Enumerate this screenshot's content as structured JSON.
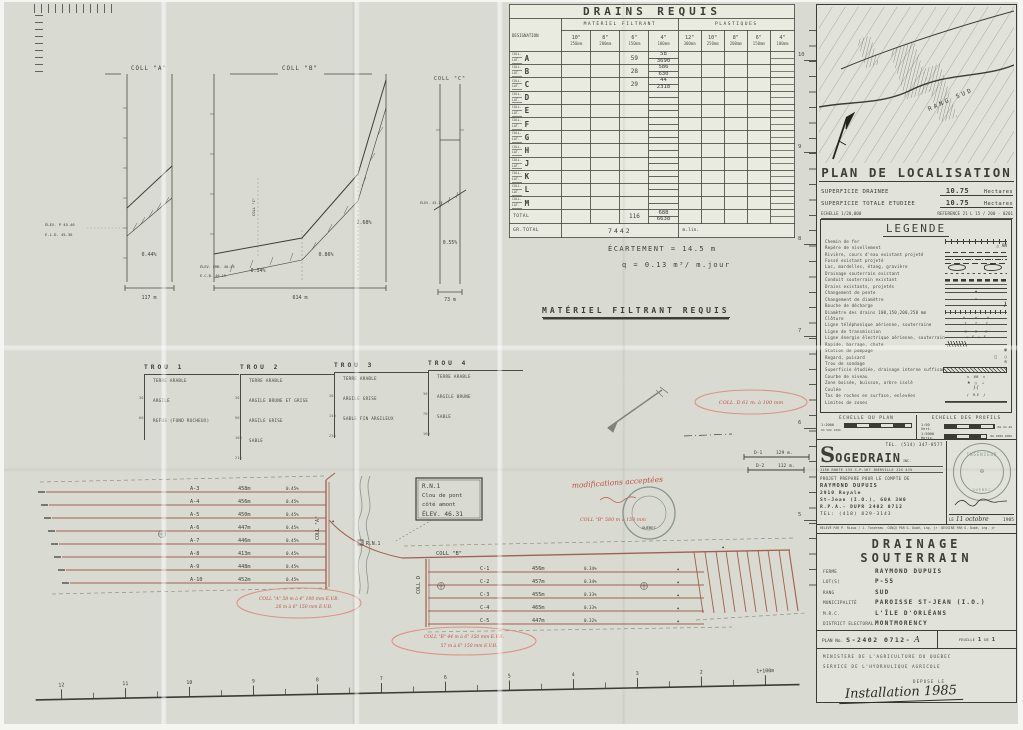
{
  "drains_table": {
    "title": "DRAINS REQUIS",
    "designation": "DESIGNATION",
    "group_filtrant": "MATÉRIEL FILTRANT",
    "group_plastiques": "PLASTIQUES",
    "coll_label": "COLL.",
    "lat_label": "LAT.",
    "cols_filtrant": [
      {
        "size": "10\"",
        "mm": "250mm"
      },
      {
        "size": "8\"",
        "mm": "200mm"
      },
      {
        "size": "6\"",
        "mm": "150mm"
      },
      {
        "size": "4\"",
        "mm": "100mm"
      }
    ],
    "cols_plastiques": [
      {
        "size": "12\"",
        "mm": "300mm"
      },
      {
        "size": "10\"",
        "mm": "250mm"
      },
      {
        "size": "8\"",
        "mm": "200mm"
      },
      {
        "size": "6\"",
        "mm": "150mm"
      },
      {
        "size": "4\"",
        "mm": "100mm"
      }
    ],
    "rows": [
      {
        "letter": "A",
        "f150": "59",
        "f100a": "58",
        "f100b": "3690"
      },
      {
        "letter": "B",
        "f150": "28",
        "f100a": "586",
        "f100b": "630"
      },
      {
        "letter": "C",
        "f150": "29",
        "f100a": "44",
        "f100b": "2318"
      },
      {
        "letter": "D",
        "f150": "",
        "f100a": "",
        "f100b": ""
      },
      {
        "letter": "E",
        "f150": "",
        "f100a": "",
        "f100b": ""
      },
      {
        "letter": "F",
        "f150": "",
        "f100a": "",
        "f100b": ""
      },
      {
        "letter": "G",
        "f150": "",
        "f100a": "",
        "f100b": ""
      },
      {
        "letter": "H",
        "f150": "",
        "f100a": "",
        "f100b": ""
      },
      {
        "letter": "J",
        "f150": "",
        "f100a": "",
        "f100b": ""
      },
      {
        "letter": "K",
        "f150": "",
        "f100a": "",
        "f100b": ""
      },
      {
        "letter": "L",
        "f150": "",
        "f100a": "",
        "f100b": ""
      },
      {
        "letter": "M",
        "f150": "",
        "f100a": "",
        "f100b": ""
      }
    ],
    "total_label": "TOTAL",
    "total_f150": "116",
    "total_f100a": "688",
    "total_f100b": "6638",
    "grand_total_label": "GR.TOTAL",
    "grand_total": "7442",
    "grand_total_unit": "m.lin."
  },
  "spacing": {
    "ecartement": "ÉCARTEMENT  =  14.5 m",
    "debit": "q =  0.13 m³/ m.jour",
    "heading": "MATÉRIEL  FILTRANT  REQUIS"
  },
  "profiles": {
    "coll_a": {
      "title": "COLL \"A\"",
      "slope": "0.44%",
      "length": "117 m",
      "note1": "ÉLEV. P  45.46",
      "note2": "E.L.D.  45.36"
    },
    "coll_b": {
      "title": "COLL \"B\"",
      "junction": "COLL \"C\"",
      "slope1": "0.34%",
      "slope2": "0.86%",
      "slope3": "2.68%",
      "length": "614 m",
      "note1": "ÉLEV. EMB.  40.45",
      "note2": "E.C.B.  40.19"
    },
    "coll_c": {
      "title": "COLL \"C\"",
      "slope": "0.55%",
      "length": "73 m",
      "note": "ÉLEV.  43.17"
    }
  },
  "trous": [
    {
      "title": "TROU 1",
      "layers": [
        {
          "d": "30",
          "n": "TERRE ARABLE"
        },
        {
          "d": "60",
          "n": "ARGILE"
        },
        {
          "d": "",
          "n": "REFUS (FOND ROCHEUX)"
        }
      ]
    },
    {
      "title": "TROU 2",
      "layers": [
        {
          "d": "30",
          "n": "TERRE ARABLE"
        },
        {
          "d": "90",
          "n": "ARGILE BRUNE ET GRISE"
        },
        {
          "d": "160",
          "n": "ARGILE GRISE"
        },
        {
          "d": "210",
          "n": "SABLE"
        }
      ]
    },
    {
      "title": "TROU 3",
      "layers": [
        {
          "d": "30",
          "n": "TERRE ARABLE"
        },
        {
          "d": "140",
          "n": "ARGILE GRISE"
        },
        {
          "d": "230",
          "n": "SABLE FIN ARGILEUX"
        }
      ]
    },
    {
      "title": "TROU 4",
      "layers": [
        {
          "d": "30",
          "n": "TERRE ARABLE"
        },
        {
          "d": "70",
          "n": "ARGILE BRUNE"
        },
        {
          "d": "160",
          "n": "SABLE"
        }
      ]
    }
  ],
  "plan": {
    "laterals_a": [
      {
        "id": "A-3",
        "len": "458m"
      },
      {
        "id": "A-4",
        "len": "456m"
      },
      {
        "id": "A-5",
        "len": "450m"
      },
      {
        "id": "A-6",
        "len": "447m"
      },
      {
        "id": "A-7",
        "len": "446m"
      },
      {
        "id": "A-8",
        "len": "413m"
      },
      {
        "id": "A-9",
        "len": "448m"
      },
      {
        "id": "A-10",
        "len": "452m"
      }
    ],
    "slope_a": "0.45%",
    "coll_a": "COLL \"A\"",
    "coll_b": "COLL \"B\"",
    "coll_d": "COLL D",
    "laterals_c": [
      {
        "id": "C-1",
        "len": "456m",
        "s": "0.34%"
      },
      {
        "id": "C-2",
        "len": "457m",
        "s": "0.34%"
      },
      {
        "id": "C-3",
        "len": "455m",
        "s": "0.33%"
      },
      {
        "id": "C-4",
        "len": "465m",
        "s": "0.33%"
      },
      {
        "id": "C-5",
        "len": "447m",
        "s": "0.32%"
      }
    ],
    "rn1": {
      "l1": "R.N.1",
      "l2": "Clou de pont",
      "l3": "côté amont",
      "l4": "ÉLEV. 46.31",
      "marker": "R.N.1"
    },
    "d1": {
      "id": "D-1",
      "len": "129 m."
    },
    "d2": {
      "id": "D-2",
      "len": "112 m."
    },
    "red_notes": {
      "modifications": "modifications acceptées",
      "coll_d": "COLL. D   61 m. à 100 mm",
      "coll_b_inline": "COLL \"B\"  580 m à 150 mm",
      "coll_a_1": "COLL \"A\"   58 m à 4\" 100 mm  E.V.B.",
      "coll_a_2": "26 m à 6\" 150 mm  E.V.B.",
      "coll_b_1": "COLL \"B\"   44 m à 6\" 150 mm  E.V.B.",
      "coll_b_2": "57 m à 6\" 150 mm  E.V.B."
    },
    "stamp_text": "QUÉBEC"
  },
  "localisation": {
    "title": "PLAN DE LOCALISATION",
    "rows": [
      {
        "label": "SUPERFICIE  DRAINEE",
        "value": "10.75",
        "unit": "Hectares"
      },
      {
        "label": "SUPERFICIE  TOTALE  ETUDIEE",
        "value": "10.75",
        "unit": "Hectares"
      }
    ],
    "echelle": "ECHELLE   1/20,000",
    "reference": "REFERENCE   21 L 15 / 200 - 0201",
    "map_label": "RANG  SUD"
  },
  "legende": {
    "title": "LEGENDE",
    "items": [
      "Chemin de fer",
      "Repère de nivellement",
      "Rivière, cours d'eau existant projeté",
      "Fossé existant projeté",
      "Lac, mardelles, étang, gravière",
      "Drainage souterrain existant",
      "Conduit souterrain existant",
      "Drains existants, projetés",
      "Changement de pente",
      "Changement de diamètre",
      "Bouche de décharge",
      "Diamètre des drains 100,150,200,250 mm",
      "Clôture",
      "Ligne téléphonique aérienne, souterraine",
      "Ligne de transmission",
      "Ligne énergie électrique aérienne, souterraine",
      "Rapide, barrage, chute",
      "Station de pompage",
      "Regard, puisard",
      "Trou de sondage",
      "Superficie étudiée, drainage interne suffisant",
      "Courbe de niveau",
      "Zone boisée, buisson, arbre isolé",
      "Coulée",
      "Tas de roches en surface, enlevées",
      "Limites de zones"
    ]
  },
  "scales": {
    "plan_title": "ECHELLE DU PLAN",
    "plan_ratio": "1:2000",
    "plan_ticks": "0m        50m        100m",
    "profils_title": "ECHELLE DES PROFILS",
    "vert_ratio": "1:50",
    "vert_label": "Vert.",
    "vert_ticks": "0m    1m    2m",
    "horiz_ratio": "1:5000",
    "horiz_label": "Horiz.",
    "horiz_ticks": "0m    100m    200m"
  },
  "sogedrain": {
    "tel_top": "TEL. (514) 347-8577",
    "name_initial": "S",
    "name_rest": "OGEDRAIN",
    "inc": "INC.",
    "address": "1156 ROUTE 133   C.P.167   IBERVILLE  J2X 4J5",
    "projet": "PROJET PREPARE POUR LE COMPTE DE",
    "client": "RAYMOND  DUPUIS",
    "client_addr1": "2910 Royale",
    "client_addr2": "St-Jean (I.O.), G0A 3W0",
    "client_rpa": "R.P.A.- DUPR 2402 0712",
    "tel_bottom": "TEL: (418) 829-3143",
    "stamp_top": "INGÉNIEUR",
    "stamp_mid": "✠",
    "stamp_bottom": "QUÉBEC",
    "date_le": "LE",
    "date_script": "11 octobre",
    "date_year": "1985",
    "releve": "RELEVÉ PAR  P. Rioux / J. Tondreau",
    "concu": "CONÇU PAR  G. Dubé, ing. jr",
    "dessine": "DESSINÉ PAR  G. Dubé, ing. jr"
  },
  "title_block": {
    "title": "DRAINAGE  SOUTERRAIN",
    "fields": [
      {
        "label": "FERME",
        "value": "RAYMOND  DUPUIS"
      },
      {
        "label": "LOT(S)",
        "value": "P-55"
      },
      {
        "label": "RANG",
        "value": "SUD"
      },
      {
        "label": "MUNICIPALITÉ",
        "value": "PAROISSE  ST-JEAN  (I.O.)"
      },
      {
        "label": "M.R.C.",
        "value": "L'ÎLE  D'ORLÉANS"
      },
      {
        "label": "DISTRICT ELECTORAL",
        "value": "MONTMORENCY"
      }
    ],
    "plan_no_label": "PLAN No.",
    "plan_no": "S-2402  0712-",
    "plan_no_suffix": "A",
    "feuille_label": "FEUILLE",
    "feuille": "1",
    "de_label": "DE",
    "feuille_total": "1",
    "ministere": "MINISTERE  DE  L'AGRICULTURE  DU  QUEBEC",
    "service": "SERVICE  DE  L'HYDRAULIQUE  AGRICOLE",
    "depose": "DEPOSE  LE",
    "handwritten": "Installation 1985"
  },
  "rulers": {
    "bottom": [
      "12",
      "11",
      "10",
      "9",
      "8",
      "7",
      "6",
      "5",
      "4",
      "3",
      "2",
      "1+100m"
    ],
    "right": [
      "10",
      "9",
      "8",
      "7",
      "6",
      "5"
    ]
  }
}
